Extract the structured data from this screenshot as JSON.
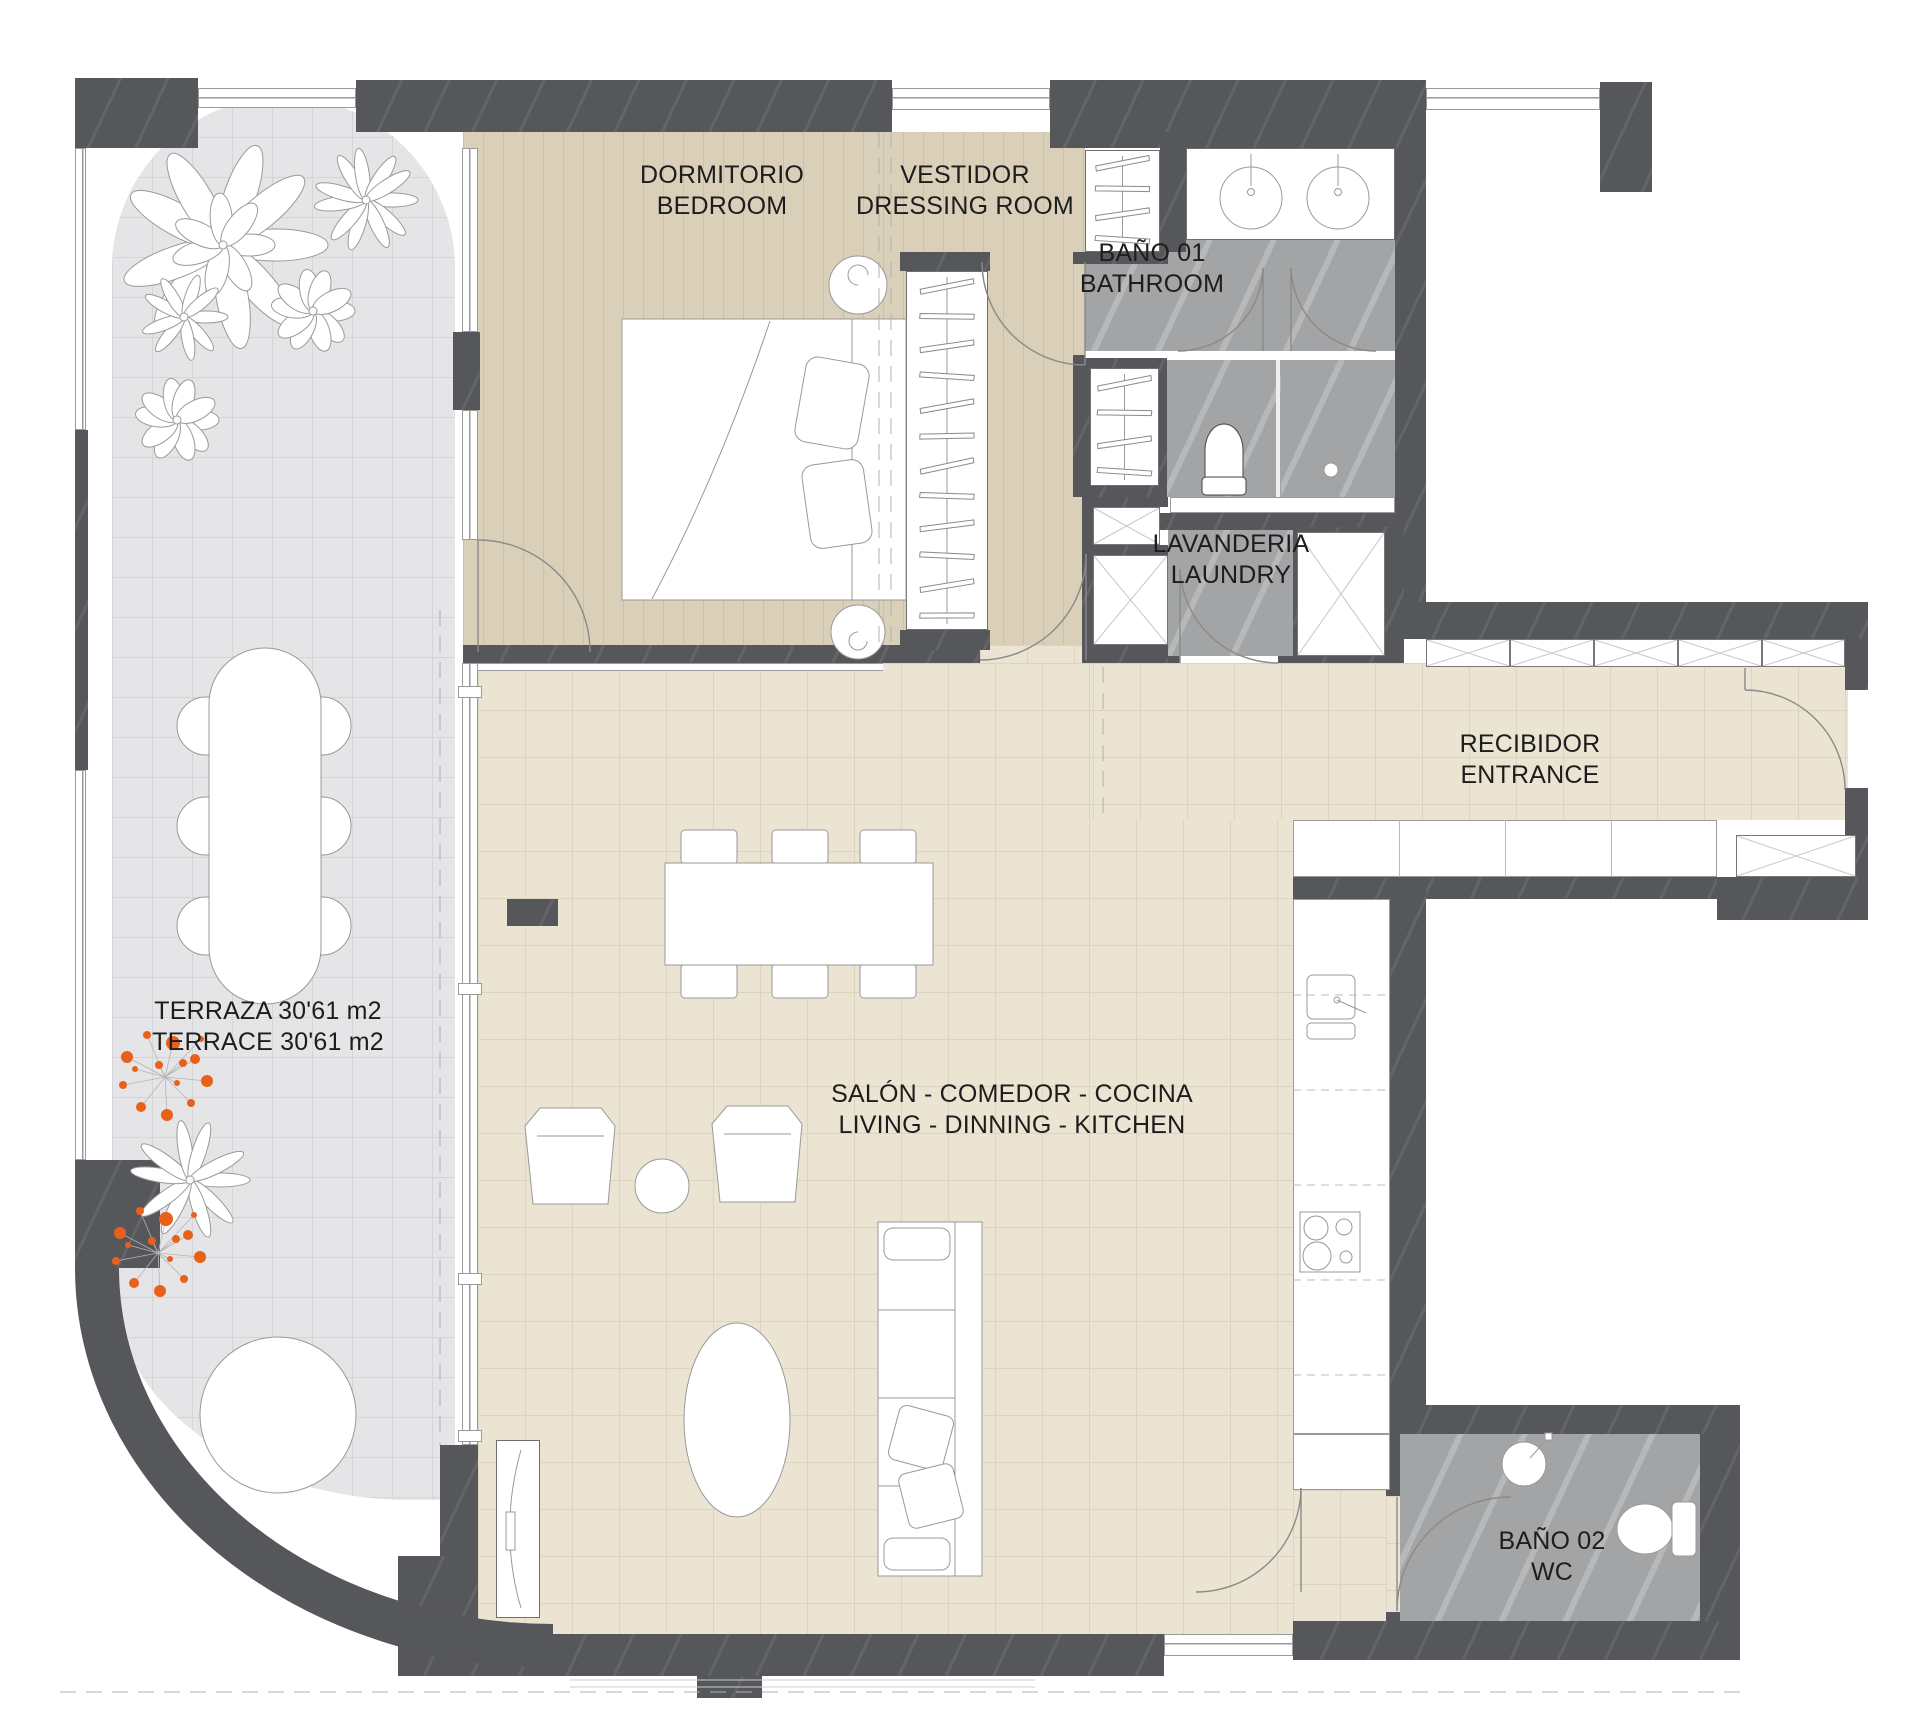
{
  "meta": {
    "drawing_type": "apartment floor plan"
  },
  "rooms": [
    {
      "id": "terrace",
      "line1": "TERRAZA 30'61 m2",
      "line2": "TERRACE 30'61 m2"
    },
    {
      "id": "bedroom",
      "line1": "DORMITORIO",
      "line2": "BEDROOM"
    },
    {
      "id": "dressing_room",
      "line1": "VESTIDOR",
      "line2": "DRESSING ROOM"
    },
    {
      "id": "bathroom_1",
      "line1": "BAÑO 01",
      "line2": "BATHROOM"
    },
    {
      "id": "laundry",
      "line1": "LAVANDERIA",
      "line2": "LAUNDRY"
    },
    {
      "id": "entrance",
      "line1": "RECIBIDOR",
      "line2": "ENTRANCE"
    },
    {
      "id": "living_dining_kitchen",
      "line1": "SALÓN - COMEDOR - COCINA",
      "line2": "LIVING - DINNING - KITCHEN"
    },
    {
      "id": "bathroom_2",
      "line1": "BAÑO 02",
      "line2": "WC"
    }
  ],
  "colors": {
    "wall": "#56575b",
    "floor_wood": "#dacfb8",
    "floor_tile": "#ebe4d3",
    "floor_terrace": "#e5e5e7",
    "floor_wet": "#a3a4a6",
    "plant_accent": "#e8611a"
  }
}
